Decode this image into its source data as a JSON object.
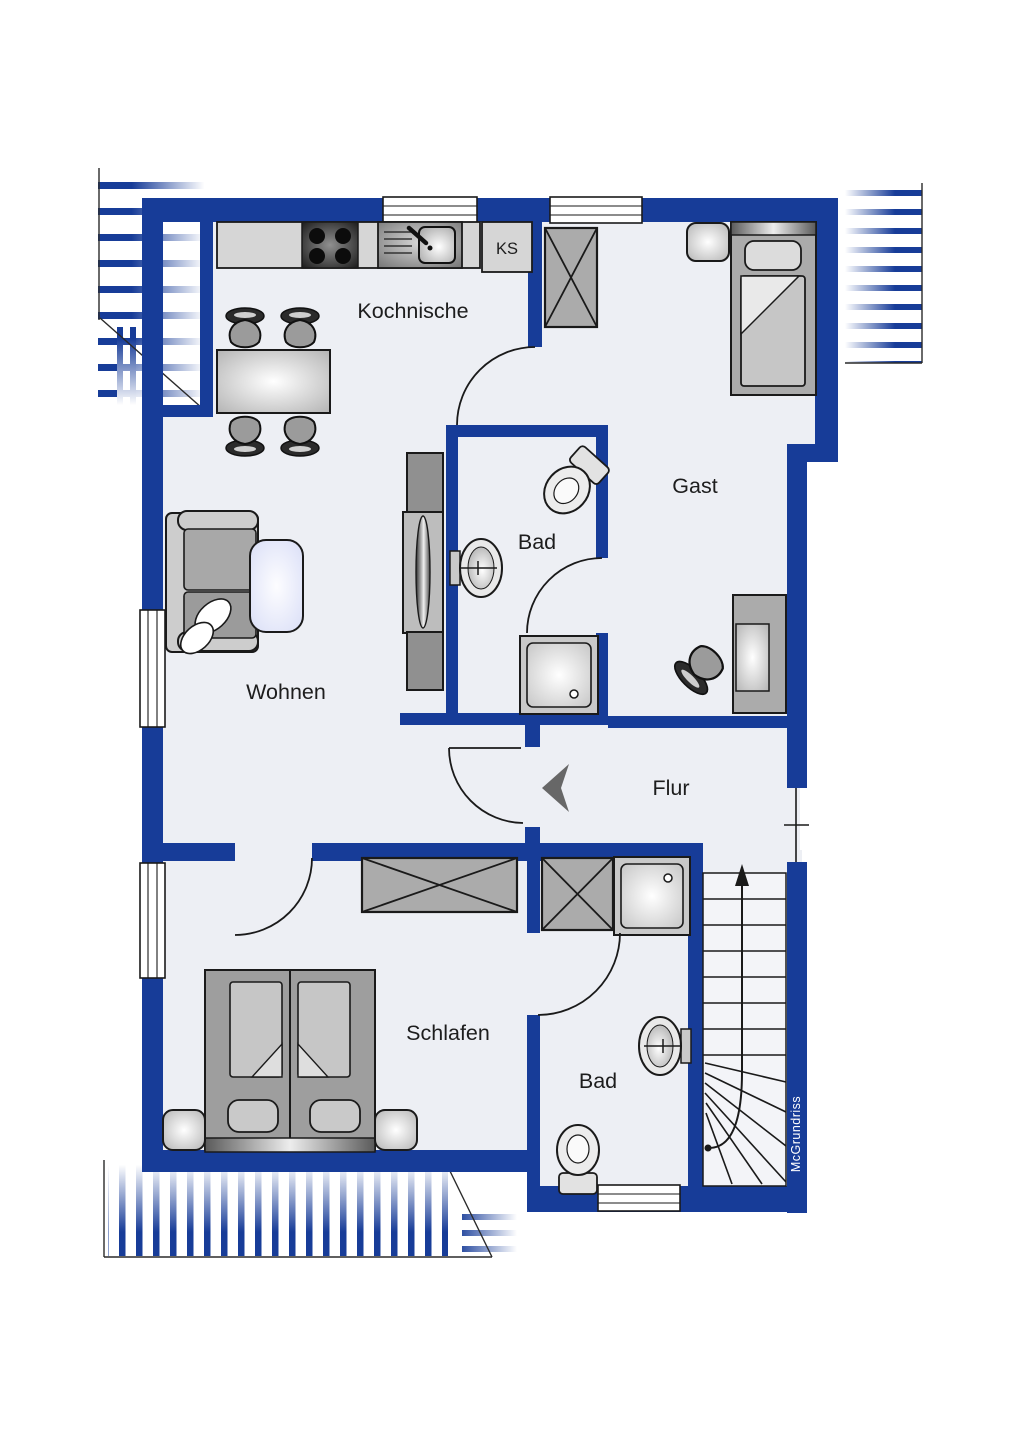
{
  "colors": {
    "wall": "#173c98",
    "floor": "#edeff4",
    "stair-floor": "#f3f4f8",
    "outline": "#1a1a1a",
    "text": "#1d1d1d",
    "table-blue": "#dce1f8",
    "arrow-gray": "#676767",
    "watermark-color": "#ffffff"
  },
  "labels": {
    "kochnische": "Kochnische",
    "gast": "Gast",
    "bad_upper": "Bad",
    "wohnen": "Wohnen",
    "flur": "Flur",
    "schlafen": "Schlafen",
    "bad_lower": "Bad",
    "ks": "KS"
  },
  "watermark": {
    "text": "McGrundriss"
  }
}
